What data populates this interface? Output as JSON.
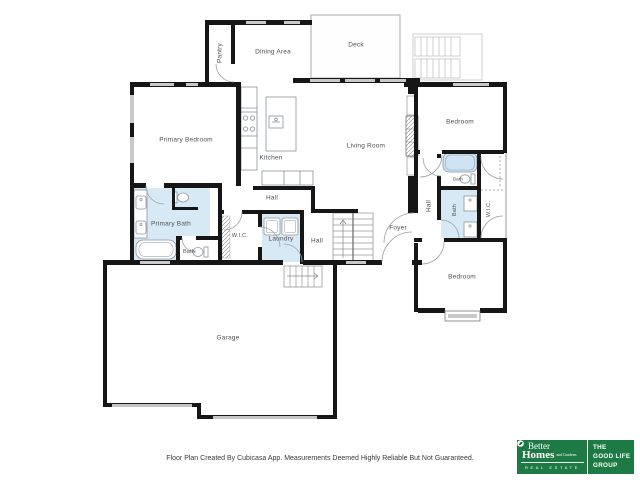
{
  "floorplan": {
    "colors": {
      "wall": "#161616",
      "window": "#c9c9c9",
      "wet_floor": "#d8e9f6",
      "tub_fill": "#cfe3f3",
      "fixture_line": "#8a959e",
      "door_arc": "#9aa0a6",
      "label_text": "#4f4f4f"
    },
    "labels": [
      {
        "id": "pantry",
        "text": "Pantry"
      },
      {
        "id": "dining-area",
        "text": "Dining Area"
      },
      {
        "id": "deck",
        "text": "Deck"
      },
      {
        "id": "primary-bedroom",
        "text": "Primary Bedroom"
      },
      {
        "id": "kitchen",
        "text": "Kitchen"
      },
      {
        "id": "living-room",
        "text": "Living Room"
      },
      {
        "id": "bedroom-upper",
        "text": "Bedroom"
      },
      {
        "id": "primary-bath",
        "text": "Primary Bath"
      },
      {
        "id": "bath-left",
        "text": "Bath"
      },
      {
        "id": "wic-middle",
        "text": "W.I.C."
      },
      {
        "id": "laundry",
        "text": "Laundry"
      },
      {
        "id": "hall-middle",
        "text": "Hall"
      },
      {
        "id": "hall-lower",
        "text": "Hall"
      },
      {
        "id": "hall-right",
        "text": "Hall"
      },
      {
        "id": "bath-upper-right",
        "text": "Bath"
      },
      {
        "id": "bath-right",
        "text": "Bath"
      },
      {
        "id": "wic-right",
        "text": "W.I.C."
      },
      {
        "id": "foyer",
        "text": "Foyer"
      },
      {
        "id": "bedroom-lower",
        "text": "Bedroom"
      },
      {
        "id": "garage",
        "text": "Garage"
      }
    ]
  },
  "footer": {
    "disclaimer": "Floor Plan Created By Cubicasa App. Measurements Deemed Highly Reliable But Not Guaranteed."
  },
  "branding": {
    "green_hex": "#1e7a45",
    "bhg": {
      "better": "Better",
      "homes": "Homes",
      "and_gardens": "and Gardens",
      "real_estate": "REAL ESTATE"
    },
    "group": {
      "line1": "THE",
      "line2": "GOOD LIFE",
      "line3": "GROUP"
    }
  }
}
